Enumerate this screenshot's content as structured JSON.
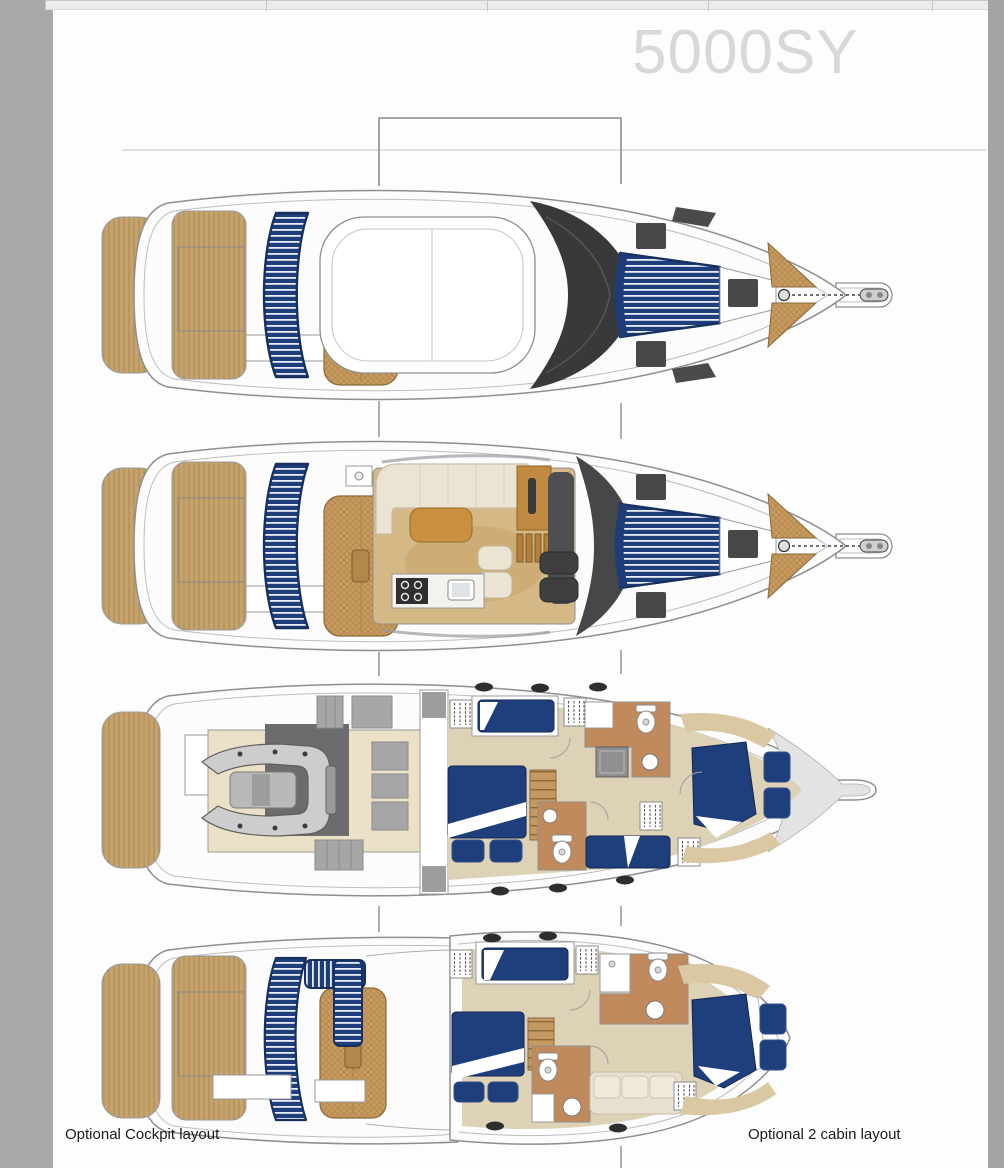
{
  "header": {
    "model_title": "5000SY"
  },
  "captions": {
    "optional_cockpit": "Optional Cockpit layout",
    "optional_two_cabin": "Optional 2 cabin layout"
  },
  "palette": {
    "upholstery_navy": "#1f3e7c",
    "teak_decking": "#c6a36e",
    "sunpad_tan": "#c79b5f",
    "cabin_floor_beige": "#ddd2b6",
    "bathroom_floor_tan": "#c08a5c",
    "hull_outline_gray": "#8f8f8f",
    "windshield_dark": "#3a3a3d",
    "page_margin_gray": "#a9a9a9",
    "title_gray": "#d8d8d8"
  }
}
